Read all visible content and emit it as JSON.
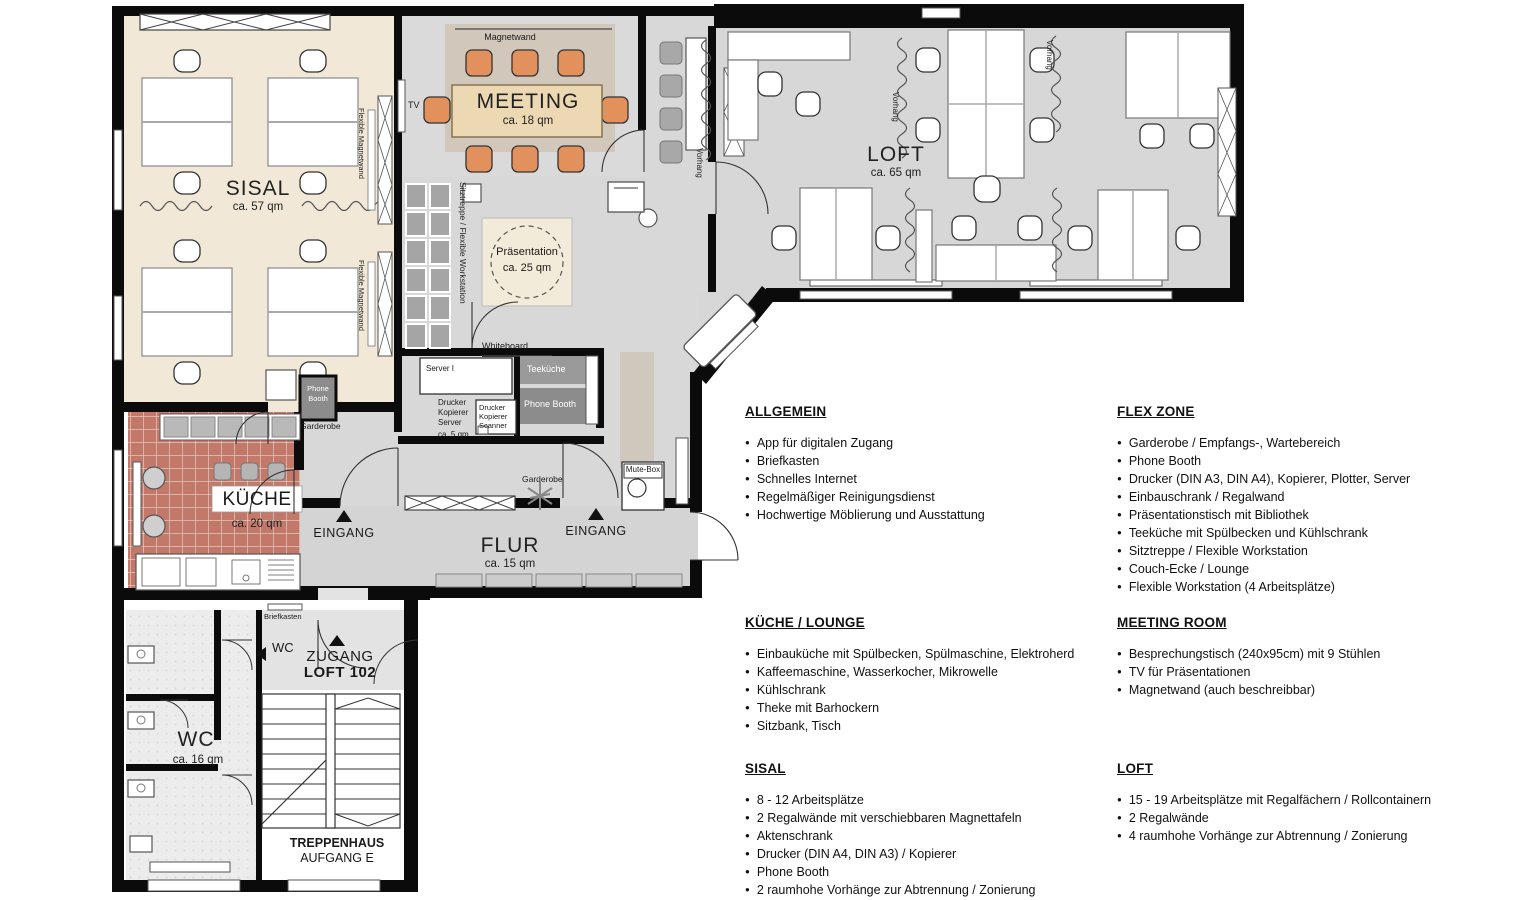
{
  "plan": {
    "rooms": {
      "sisal": {
        "name": "SISAL",
        "area": "ca. 57 qm"
      },
      "meeting": {
        "name": "MEETING",
        "area": "ca. 18 qm"
      },
      "loft": {
        "name": "LOFT",
        "area": "ca. 65 qm"
      },
      "praesentation": {
        "name": "Präsentation",
        "area": "ca. 25 qm"
      },
      "kueche": {
        "name": "KÜCHE",
        "area": "ca. 20 qm"
      },
      "flur": {
        "name": "FLUR",
        "area": "ca. 15 qm"
      },
      "wc": {
        "name": "WC",
        "area": "ca. 16 qm"
      },
      "server": {
        "name": "Server I",
        "lines": [
          "Drucker",
          "Kopierer",
          "Server"
        ],
        "area": "ca. 5 qm"
      },
      "zugang": {
        "line1": "ZUGANG",
        "line2": "LOFT 102"
      },
      "treppenhaus": {
        "line1": "TREPPENHAUS",
        "line2": "AUFGANG E"
      }
    },
    "labels": {
      "magnetwand": "Magnetwand",
      "tv": "TV",
      "vorhang": "Vorhang",
      "flexible_magnetwand": "Flexible Magnetwand",
      "sitztreppe": "Sitztreppe / Flexible Workstation",
      "whiteboard": "Whiteboard",
      "teekueche": "Teeküche",
      "phone_booth": "Phone Booth",
      "phone_booth_line1": "Phone",
      "phone_booth_line2": "Booth",
      "scanner_lines": [
        "Drucker",
        "Kopierer",
        "Scanner"
      ],
      "garderobe": "Garderobe",
      "eingang": "EINGANG",
      "mute_box": "Mute-Box",
      "briefkasten": "Briefkasten",
      "wc_door": "WC"
    },
    "colors": {
      "wall": "#0b0b0b",
      "sisal_floor": "#f1e8d7",
      "meeting_floor": "#dadada",
      "loft_floor": "#d7d7d7",
      "kueche_floor": "#c3796a",
      "chair_orange": "#e2915c",
      "booth_dark": "#8c8c8c",
      "presentation_beige": "#f3ebd9"
    }
  },
  "legend": [
    {
      "title": "ALLGEMEIN",
      "items": [
        "App für digitalen Zugang",
        "Briefkasten",
        "Schnelles Internet",
        "Regelmäßiger Reinigungsdienst",
        "Hochwertige Möblierung und Ausstattung"
      ]
    },
    {
      "title": "FLEX ZONE",
      "items": [
        "Garderobe / Empfangs-, Wartebereich",
        "Phone Booth",
        "Drucker (DIN A3, DIN A4), Kopierer, Plotter, Server",
        "Einbauschrank / Regalwand",
        "Präsentationstisch mit Bibliothek",
        "Teeküche mit Spülbecken und Kühlschrank",
        "Sitztreppe / Flexible Workstation",
        "Couch-Ecke / Lounge",
        "Flexible Workstation (4 Arbeitsplätze)"
      ]
    },
    {
      "title": "KÜCHE / LOUNGE",
      "items": [
        "Einbauküche mit Spülbecken, Spülmaschine, Elektroherd",
        "Kaffeemaschine, Wasserkocher, Mikrowelle",
        "Kühlschrank",
        "Theke mit Barhockern",
        "Sitzbank, Tisch"
      ]
    },
    {
      "title": "MEETING ROOM",
      "items": [
        "Besprechungstisch (240x95cm) mit 9 Stühlen",
        "TV für Präsentationen",
        "Magnetwand (auch beschreibbar)"
      ]
    },
    {
      "title": "SISAL",
      "items": [
        "8 - 12 Arbeitsplätze",
        "2 Regalwände mit verschiebbaren Magnettafeln",
        "Aktenschrank",
        "Drucker (DIN A4, DIN A3) / Kopierer",
        "Phone Booth",
        "2 raumhohe Vorhänge zur Abtrennung / Zonierung"
      ]
    },
    {
      "title": "LOFT",
      "items": [
        "15 - 19 Arbeitsplätze mit Regalfächern / Rollcontainern",
        "2 Regalwände",
        "4 raumhohe Vorhänge zur Abtrennung / Zonierung"
      ]
    }
  ]
}
